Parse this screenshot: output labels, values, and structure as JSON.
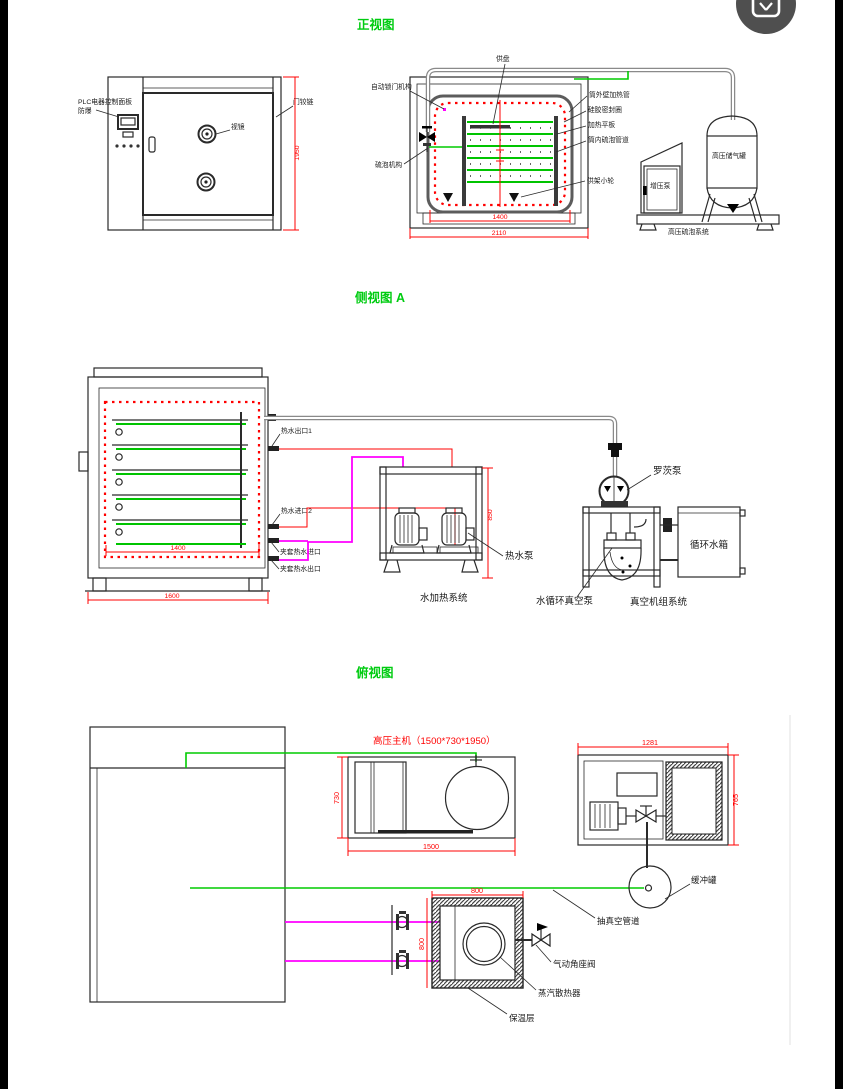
{
  "colors": {
    "accent_green": "#00cc11",
    "dim_red": "#ff0000",
    "pipe_magenta": "#ff00ff",
    "line_dark": "#2a2a2a"
  },
  "corner_icon": {
    "name": "image-search-icon"
  },
  "fv": {
    "title": "正视图",
    "plc1": "PLC电器控制面板",
    "plc2": "防爆",
    "hinge": "门铰链",
    "sight": "视镜",
    "dim_h": "1950",
    "tray": "供盘",
    "autolock": "自动锁门机构",
    "outer_pipe": "筒外壁加热管",
    "seal": "硅胶密封圈",
    "plate": "加热平板",
    "inner_pipe": "筒内硫泡管道",
    "wheel": "供架小轮",
    "mech": "硫泡机构",
    "dim1400": "1400",
    "dim2110": "2110",
    "booster": "增压泵",
    "airtank": "高压储气罐",
    "system": "高压硫泡系统"
  },
  "sv": {
    "title": "侧视图 A",
    "out1": "热水出口1",
    "in2": "热水进口2",
    "jacket_in": "夹套热水进口",
    "jacket_out": "夹套热水出口",
    "pump": "热水泵",
    "heat_sys": "水加热系统",
    "roots": "罗茨泵",
    "tank": "循环水箱",
    "vac_pump": "水循环真空泵",
    "vac_sys": "真空机组系统",
    "dim850": "850",
    "dim1400": "1400",
    "dim1600": "1600"
  },
  "tv": {
    "title": "俯视图",
    "main": "高压主机（1500*730*1950）",
    "dim730": "730",
    "dim1500": "1500",
    "dim1281": "1281",
    "dim765": "765",
    "dim800t": "800",
    "dim800l": "800",
    "buffer": "缓冲罐",
    "vacpipe": "抽真空管道",
    "valve": "气动角座阀",
    "radiator": "蒸汽散热器",
    "insulation": "保温层"
  }
}
